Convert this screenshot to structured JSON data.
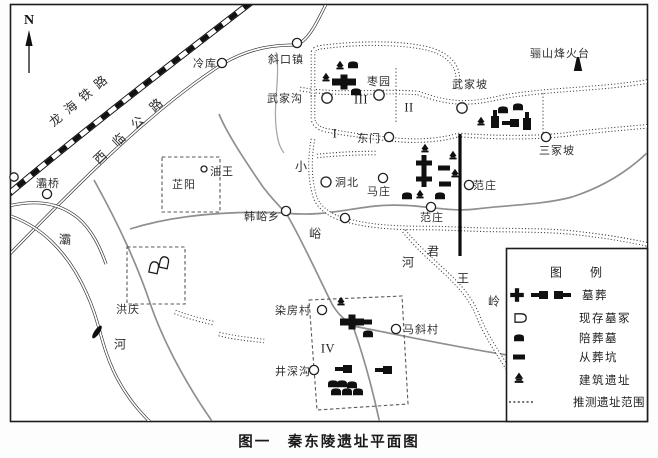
{
  "caption": "图一　秦东陵遗址平面图",
  "compass": {
    "label": "N"
  },
  "roads": {
    "railway": "龙海铁路",
    "highway": "西临公路"
  },
  "zones": [
    {
      "id": "zone-1",
      "label": "I"
    },
    {
      "id": "zone-2",
      "label": "II"
    },
    {
      "id": "zone-3",
      "label": "III"
    },
    {
      "id": "zone-4",
      "label": "IV"
    }
  ],
  "places": [
    {
      "name": "baqiao",
      "label": "灞桥"
    },
    {
      "name": "lengku",
      "label": "冷库"
    },
    {
      "name": "xiekouzhen",
      "label": "斜口镇"
    },
    {
      "name": "wujiagou",
      "label": "武家沟"
    },
    {
      "name": "zaoyuan",
      "label": "枣园"
    },
    {
      "name": "wujiapo",
      "label": "武家坡"
    },
    {
      "name": "lishan-fenghuotai",
      "label": "骊山烽火台"
    },
    {
      "name": "sanzhongpo",
      "label": "三冢坡"
    },
    {
      "name": "dongmen",
      "label": "东门"
    },
    {
      "name": "youwang",
      "label": "油王"
    },
    {
      "name": "zhiyang",
      "label": "芷阳"
    },
    {
      "name": "hanyuxiang",
      "label": "韩峪乡"
    },
    {
      "name": "dongbei",
      "label": "洞北"
    },
    {
      "name": "mazhuang",
      "label": "马庄"
    },
    {
      "name": "fanzhuang-east",
      "label": "范庄"
    },
    {
      "name": "fanzhuang-south",
      "label": "范庄"
    },
    {
      "name": "hongqing",
      "label": "洪庆"
    },
    {
      "name": "ranfangcun",
      "label": "染房村"
    },
    {
      "name": "maxiecun",
      "label": "马斜村"
    },
    {
      "name": "jingshengou",
      "label": "井深沟"
    }
  ],
  "terrain_chars": [
    {
      "name": "ba-river-1",
      "ch": "灞"
    },
    {
      "name": "ba-river-2",
      "ch": "河"
    },
    {
      "name": "xiaoyu-river-1",
      "ch": "小"
    },
    {
      "name": "xiaoyu-river-2",
      "ch": "峪"
    },
    {
      "name": "xiaoyu-river-3",
      "ch": "河"
    },
    {
      "name": "junwangling-1",
      "ch": "君"
    },
    {
      "name": "junwangling-2",
      "ch": "王"
    },
    {
      "name": "junwangling-3",
      "ch": "岭"
    }
  ],
  "legend": {
    "title": "图　例",
    "items": [
      {
        "name": "tombs",
        "label": "墓葬"
      },
      {
        "name": "existing-mounds",
        "label": "现存墓冢"
      },
      {
        "name": "accompanying-tombs",
        "label": "陪葬墓"
      },
      {
        "name": "sacrificial-pits",
        "label": "从葬坑"
      },
      {
        "name": "building-remains",
        "label": "建筑遗址"
      },
      {
        "name": "estimated-site-extent",
        "label": "推测遗址范围"
      }
    ]
  },
  "colors": {
    "ink": "#1c1c1c",
    "gray_road": "#8f8f8f",
    "background": "#ffffff"
  }
}
